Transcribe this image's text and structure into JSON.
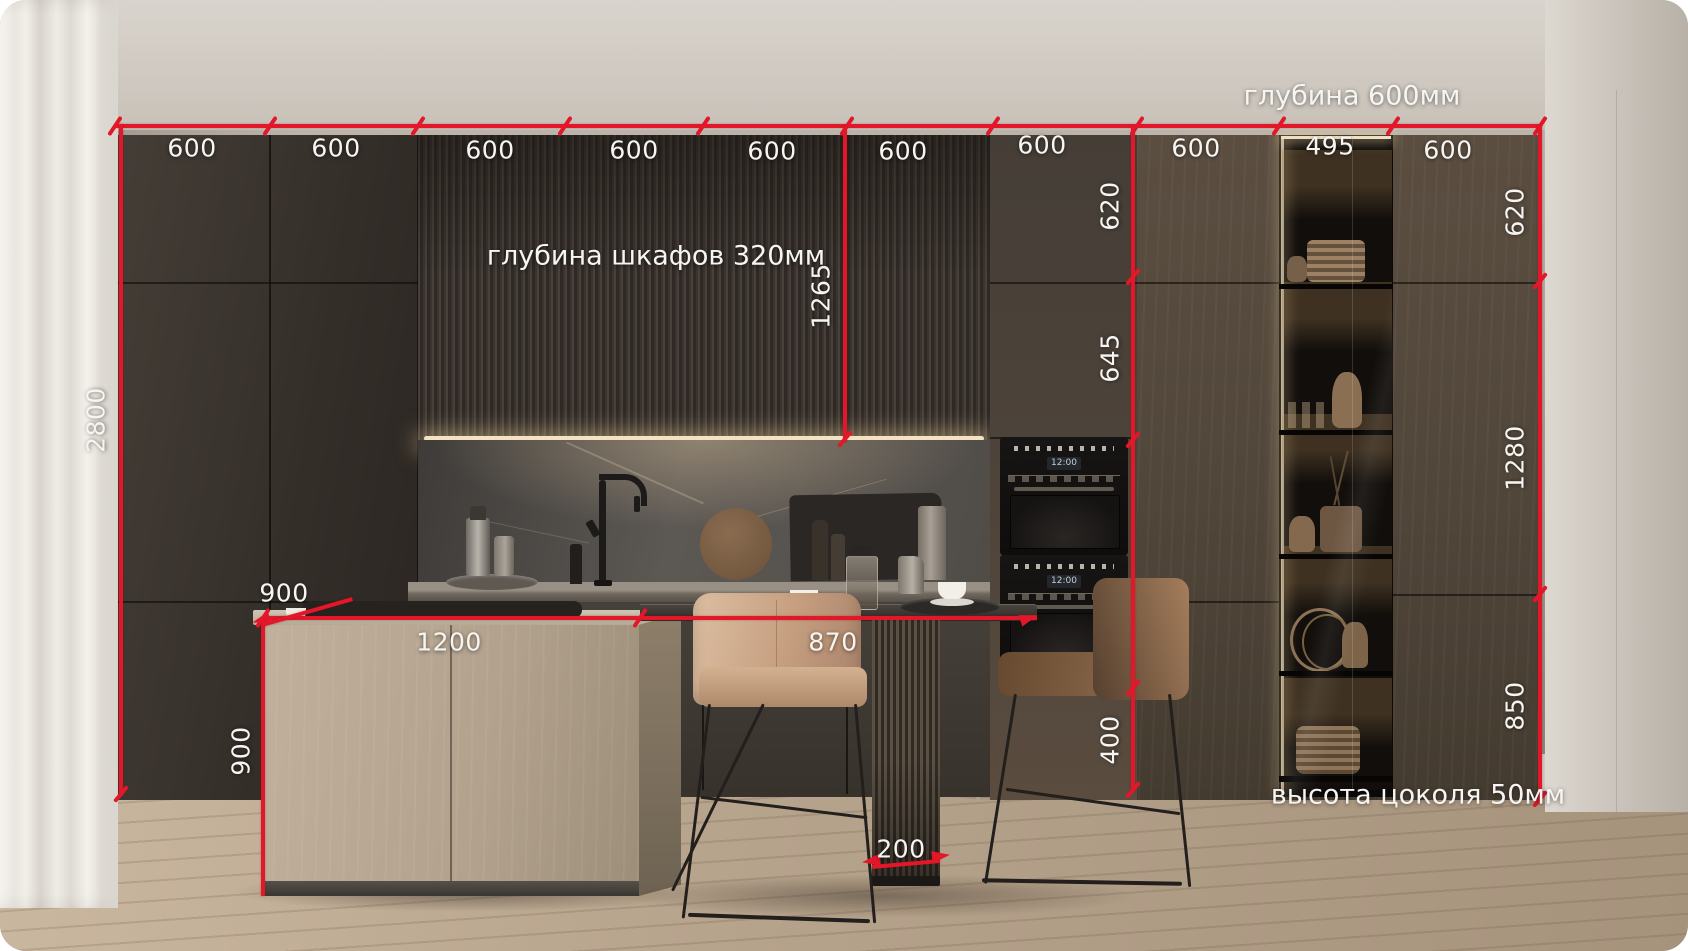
{
  "annotations": {
    "top_widths": [
      "600",
      "600",
      "600",
      "600",
      "600",
      "600",
      "600",
      "600",
      "495",
      "600"
    ],
    "total_height": "2800",
    "upper_section_height": "1265",
    "mid_heights": [
      "620",
      "645",
      "400"
    ],
    "right_heights": [
      "620",
      "1280",
      "850"
    ],
    "island": {
      "depth": "900",
      "width": "1200",
      "height": "900"
    },
    "table": {
      "height": "870",
      "base_width": "200"
    },
    "notes": {
      "cabinet_depth_right": "глубина 600мм",
      "upper_cabinet_depth": "глубина шкафов 320мм",
      "plinth_height": "высота цоколя 50мм"
    },
    "colors": {
      "dimension_red": "#e2182a",
      "label_white": "#f7f5f2"
    }
  },
  "appliances": {
    "oven_display": "12:00"
  }
}
